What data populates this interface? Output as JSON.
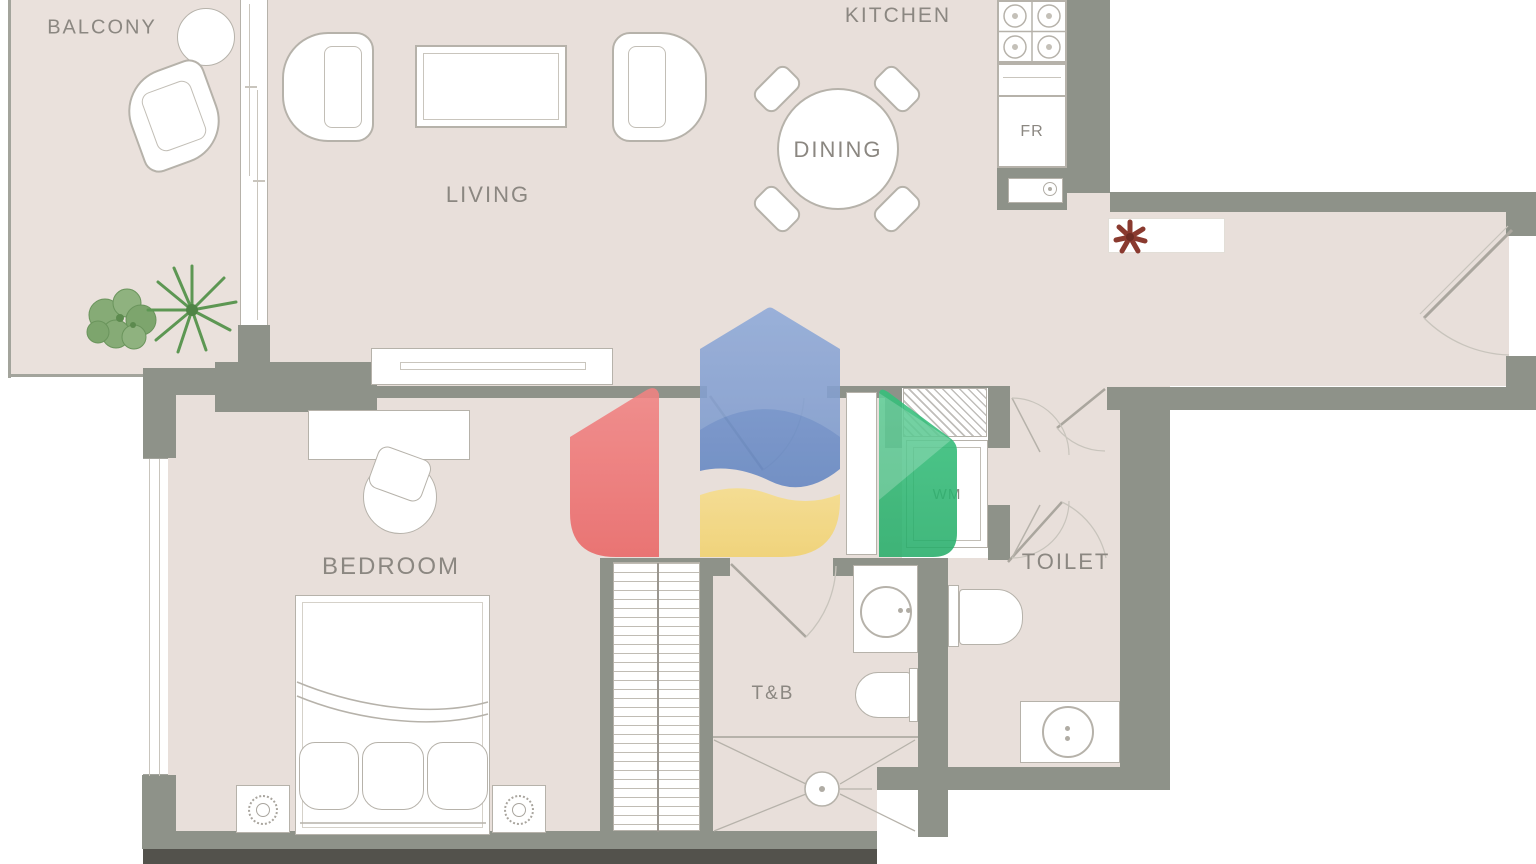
{
  "rooms": {
    "balcony": {
      "label": "BALCONY"
    },
    "living": {
      "label": "LIVING"
    },
    "kitchen": {
      "label": "KITCHEN"
    },
    "dining": {
      "label": "DINING"
    },
    "bedroom": {
      "label": "BEDROOM"
    },
    "toilet": {
      "label": "TOILET"
    },
    "tb": {
      "label": "T&B"
    }
  },
  "appliances": {
    "fridge": {
      "label": "FR"
    },
    "washer": {
      "label": "WM"
    }
  },
  "colors": {
    "floor": "#e8dfda",
    "wall": "#8e9289",
    "furniture_outline": "#b6b2aa",
    "label_text": "#8b8781",
    "plant_green": "#6f9b60",
    "flower_red": "#8a3a2f",
    "logo_red": "#ee6f6f",
    "logo_blue": "#7094cc",
    "logo_yellow": "#f5d97e",
    "logo_green": "#2eba74"
  },
  "watermark": {
    "name": "house-logo-watermark"
  }
}
